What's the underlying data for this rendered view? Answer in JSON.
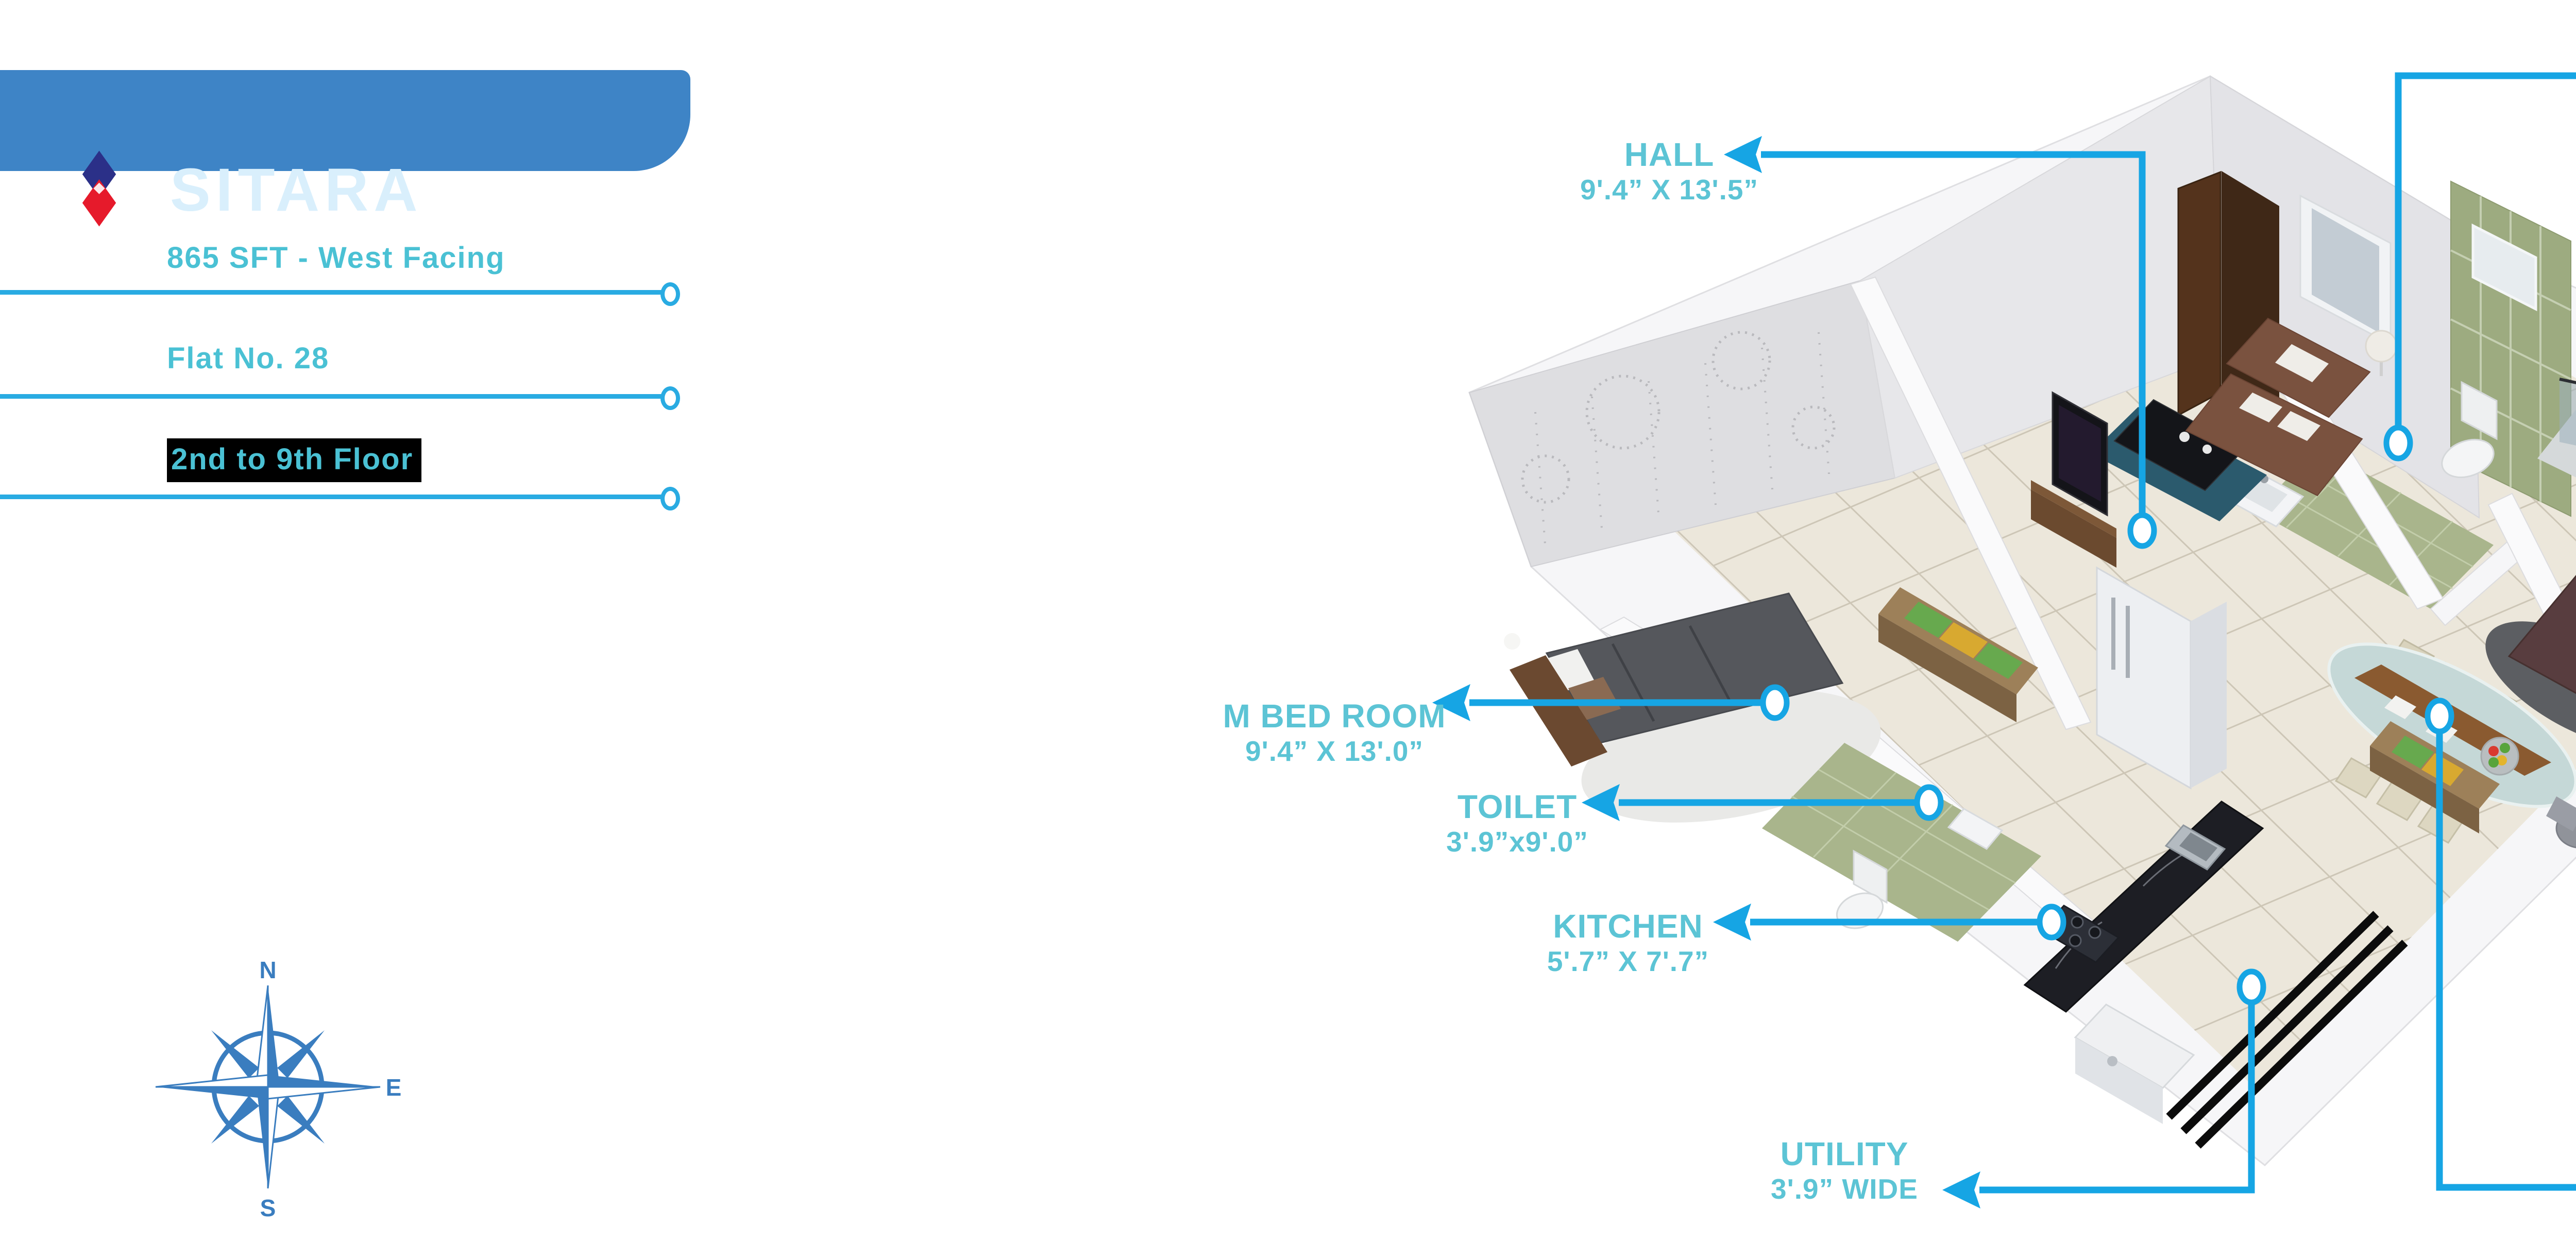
{
  "brand": {
    "title": "SITARA"
  },
  "specs": {
    "area_facing": "865 SFT - West Facing",
    "flat_no": "Flat No. 28",
    "floor_range": "2nd to 9th Floor"
  },
  "compass": {
    "north": "N",
    "east": "E",
    "south": "S"
  },
  "rooms": [
    {
      "id": "hall",
      "name": "HALL",
      "dims": "9'.4” X 13'.5”"
    },
    {
      "id": "toilet-top",
      "name": "TOILET",
      "dims": "3'.8” X 7'.6”"
    },
    {
      "id": "balcony",
      "name": "BALCONY",
      "dims": "4'.0” WIDE"
    },
    {
      "id": "m-bed-room",
      "name": "M BED ROOM",
      "dims": "9'.4” X 13'.0”"
    },
    {
      "id": "toilet-bottom",
      "name": "TOILET",
      "dims": "3'.9”x9'.0”"
    },
    {
      "id": "kitchen",
      "name": "KITCHEN",
      "dims": "5'.7” X 7'.7”"
    },
    {
      "id": "utility",
      "name": "UTILITY",
      "dims": "3'.9” WIDE"
    },
    {
      "id": "c-bed-room",
      "name": "C BED ROOM",
      "dims": "9'.2” X 10'.0”"
    },
    {
      "id": "dining",
      "name": "DINING",
      "dims": "13'.4” X 8'.10”"
    }
  ],
  "colors": {
    "accent_cyan": "#16a5e4",
    "label_teal": "#5cc4d5",
    "banner_blue": "#3e84c6",
    "logo_navy": "#2b3088",
    "logo_red": "#e61a2b",
    "compass_blue": "#3a7dbf",
    "floor_highlight_bg": "#000000"
  }
}
